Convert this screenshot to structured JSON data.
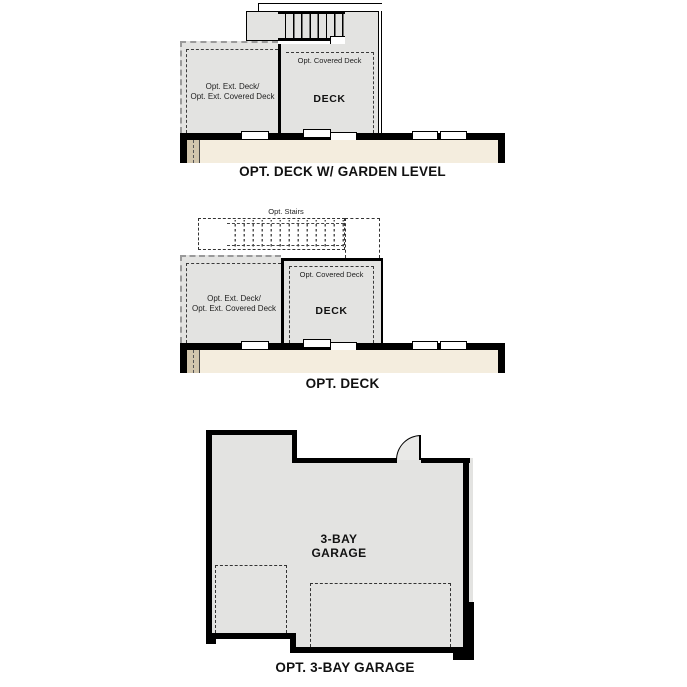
{
  "colors": {
    "wall": "#000000",
    "deck_fill": "#e3e3e1",
    "basement_fill": "#f4edde",
    "basement_dark_cell": "#d2c6ad",
    "dashed_dark": "#3a3a3a",
    "dashed_gray": "#9a9a9a",
    "background": "#ffffff"
  },
  "diagrams": {
    "garden_level": {
      "caption": "OPT. DECK W/ GARDEN LEVEL",
      "left_deck_label_line1": "Opt. Ext. Deck/",
      "left_deck_label_line2": "Opt. Ext. Covered Deck",
      "covered_deck_label": "Opt. Covered Deck",
      "deck_label": "DECK"
    },
    "opt_deck": {
      "caption": "OPT. DECK",
      "stairs_label": "Opt. Stairs",
      "left_deck_label_line1": "Opt. Ext. Deck/",
      "left_deck_label_line2": "Opt. Ext. Covered Deck",
      "covered_deck_label": "Opt. Covered Deck",
      "deck_label": "DECK"
    },
    "garage": {
      "caption": "OPT. 3-BAY GARAGE",
      "room_label_line1": "3-BAY",
      "room_label_line2": "GARAGE"
    }
  }
}
